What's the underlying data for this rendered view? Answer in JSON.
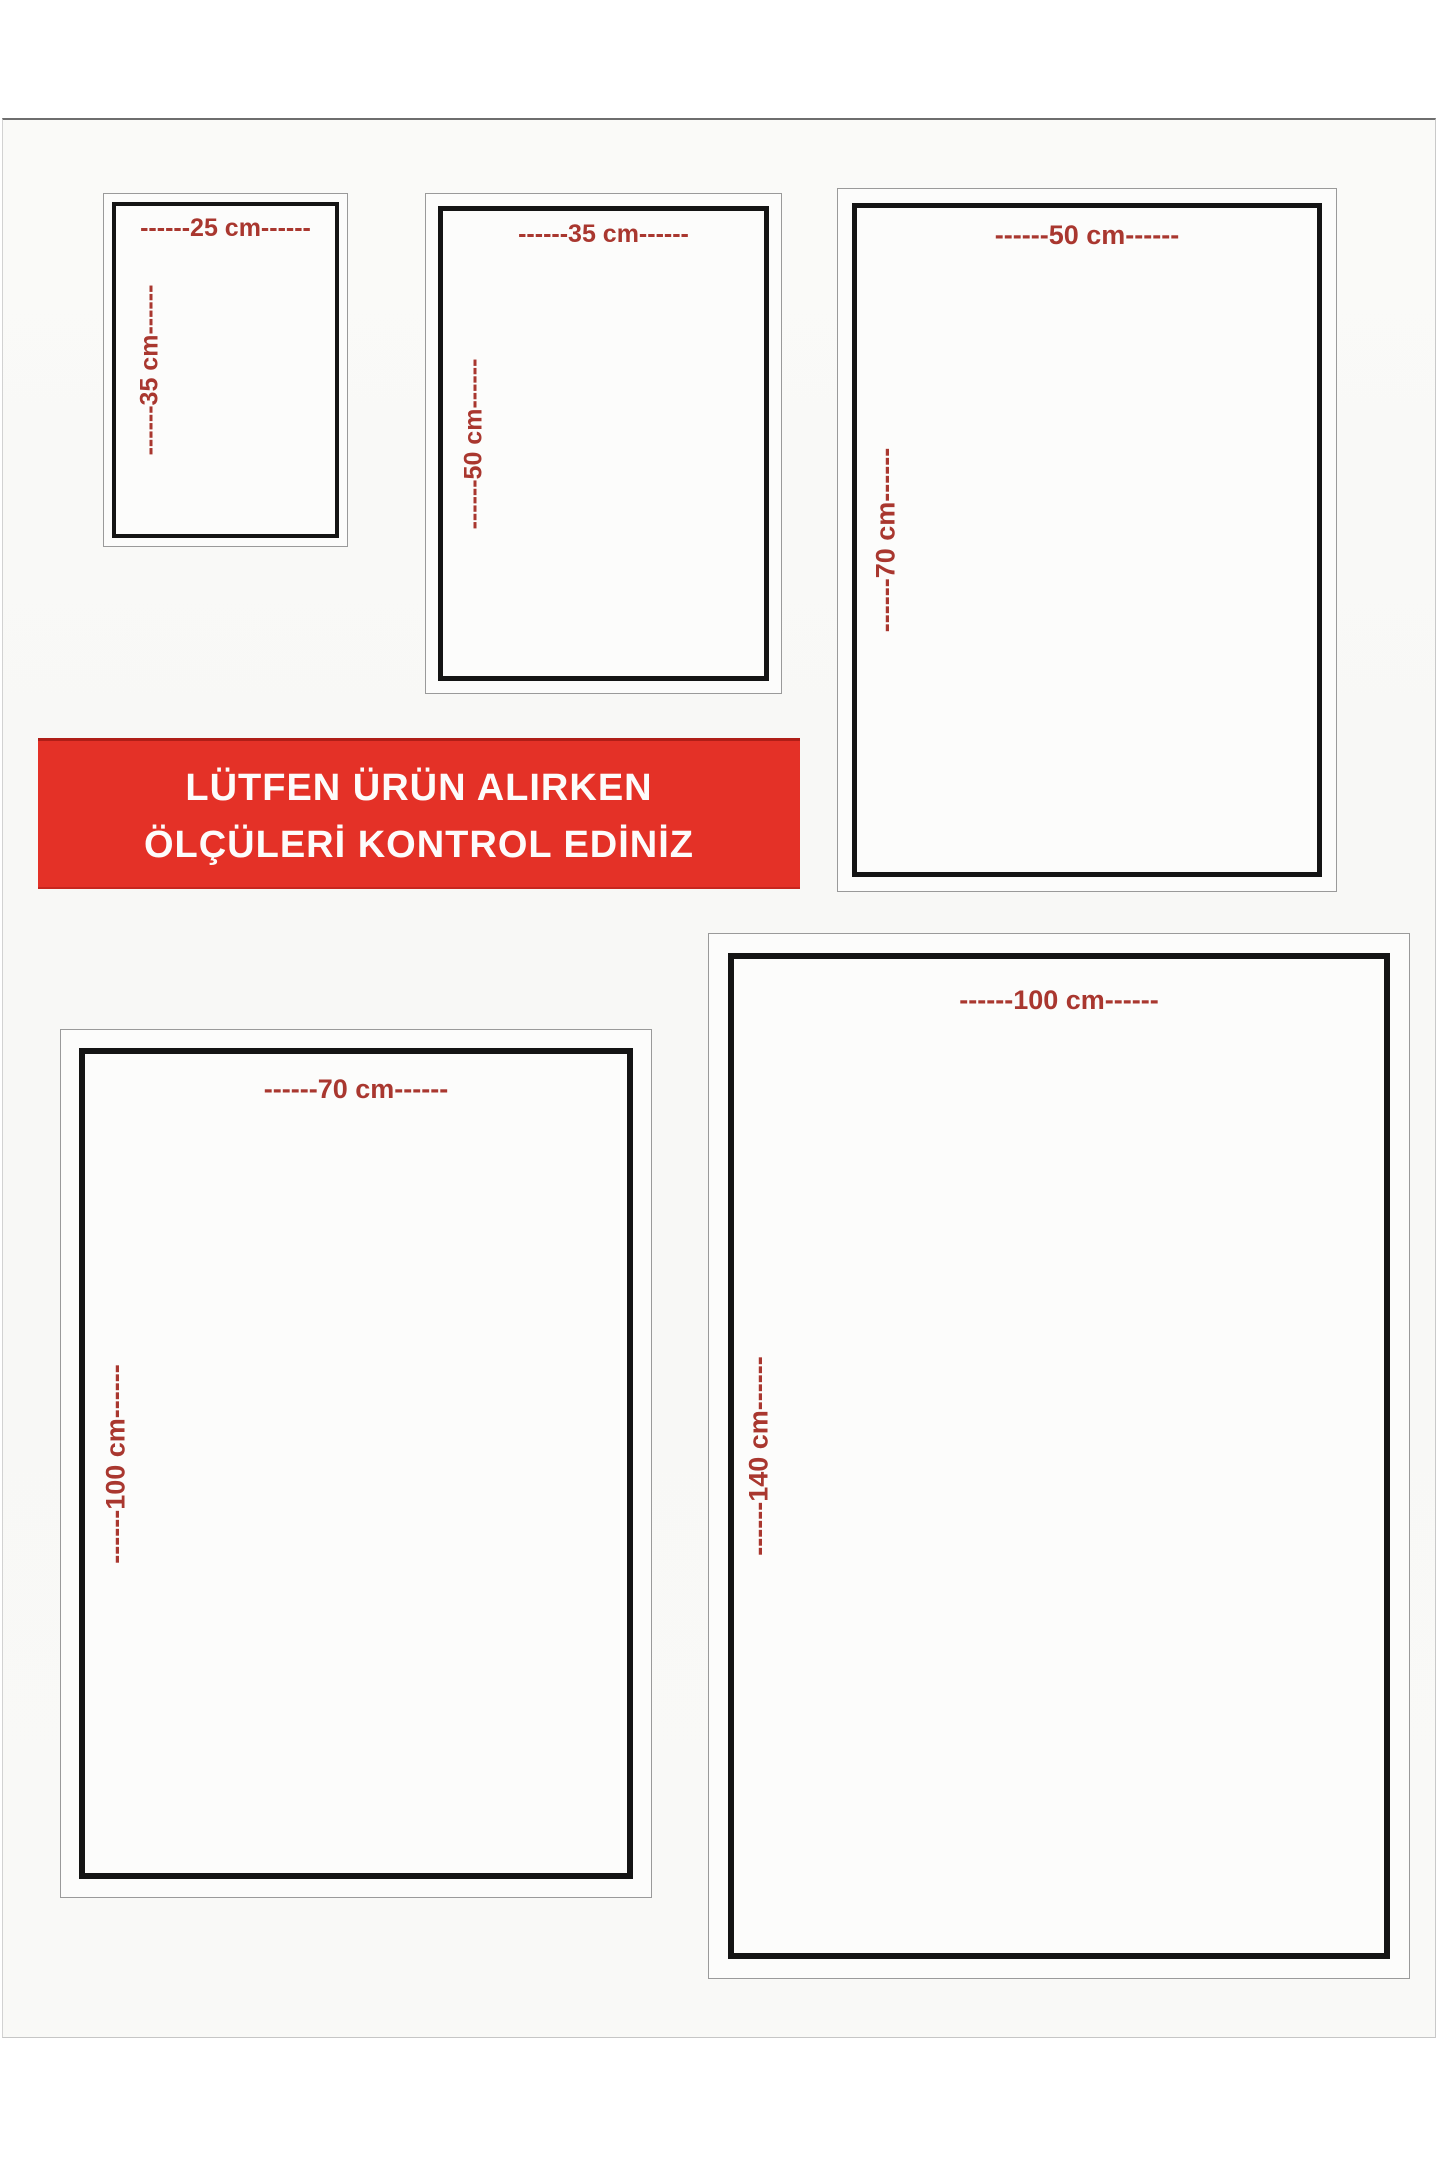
{
  "banner": {
    "line1": "LÜTFEN ÜRÜN ALIRKEN",
    "line2": "ÖLÇÜLERİ KONTROL EDİNİZ",
    "bg_color": "#e43127",
    "text_color": "#ffffff"
  },
  "label_color": "#a9372f",
  "sizes": [
    {
      "id": "25x35",
      "width_cm": 25,
      "height_cm": 35,
      "width_label": "------25 cm------",
      "height_label": "------35 cm------"
    },
    {
      "id": "35x50",
      "width_cm": 35,
      "height_cm": 50,
      "width_label": "------35 cm------",
      "height_label": "------50 cm------"
    },
    {
      "id": "50x70",
      "width_cm": 50,
      "height_cm": 70,
      "width_label": "------50 cm------",
      "height_label": "------70 cm------"
    },
    {
      "id": "70x100",
      "width_cm": 70,
      "height_cm": 100,
      "width_label": "------70 cm------",
      "height_label": "------100 cm------"
    },
    {
      "id": "100x140",
      "width_cm": 100,
      "height_cm": 140,
      "width_label": "------100 cm------",
      "height_label": "------140 cm------"
    }
  ]
}
